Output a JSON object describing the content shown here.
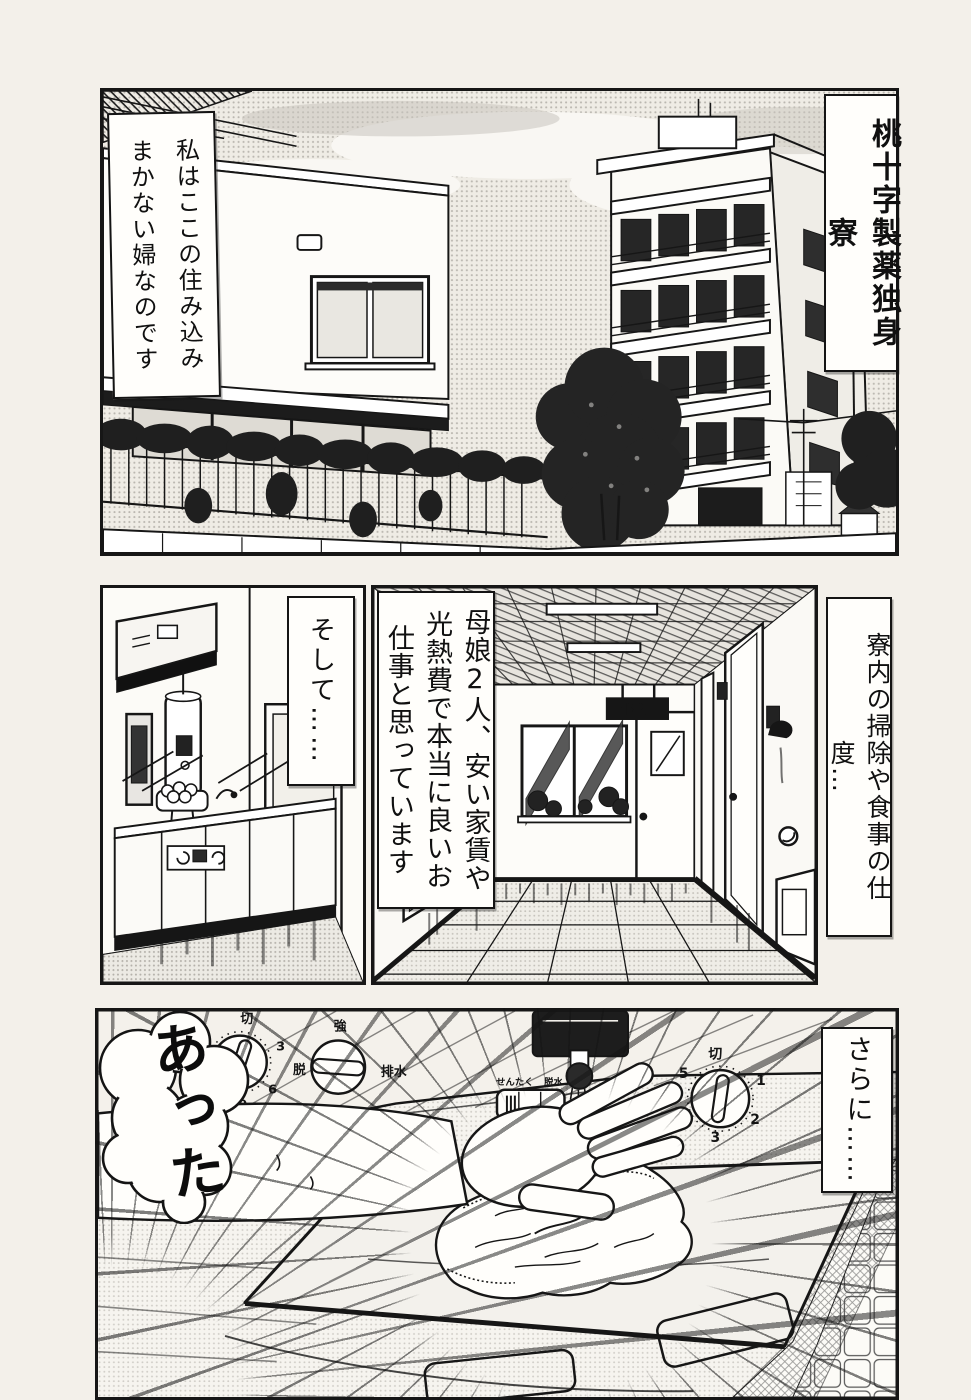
{
  "colors": {
    "ink": "#161616",
    "paper": "#f3f0ea",
    "panel_bg": "#fcfbf7"
  },
  "panel1": {
    "caption_right": "桃十字製薬独身寮",
    "caption_left": "私はここの住み込みまかない婦なのです"
  },
  "panel2": {
    "caption": "そして……"
  },
  "panel3": {
    "caption": "母娘2人、安い家賃や光熱費で本当に良いお仕事と思っています",
    "caption_right": "寮内の掃除や食事の仕度…",
    "exit_sign": "非常口"
  },
  "panel4": {
    "exclamation": "あった",
    "caption_right": "さらに……",
    "timer_dial": {
      "off": "切",
      "n3": "3",
      "n6": "6",
      "n9": "9",
      "n12": "12"
    },
    "course_dial": {
      "top": "強",
      "left": "脱",
      "right": "排水"
    },
    "course_switch": {
      "left": "せんたく",
      "right": "脱水"
    },
    "spin_dial": {
      "off": "切",
      "n1": "1",
      "n2": "2",
      "n3": "3",
      "n4": "4",
      "n5": "5"
    }
  }
}
